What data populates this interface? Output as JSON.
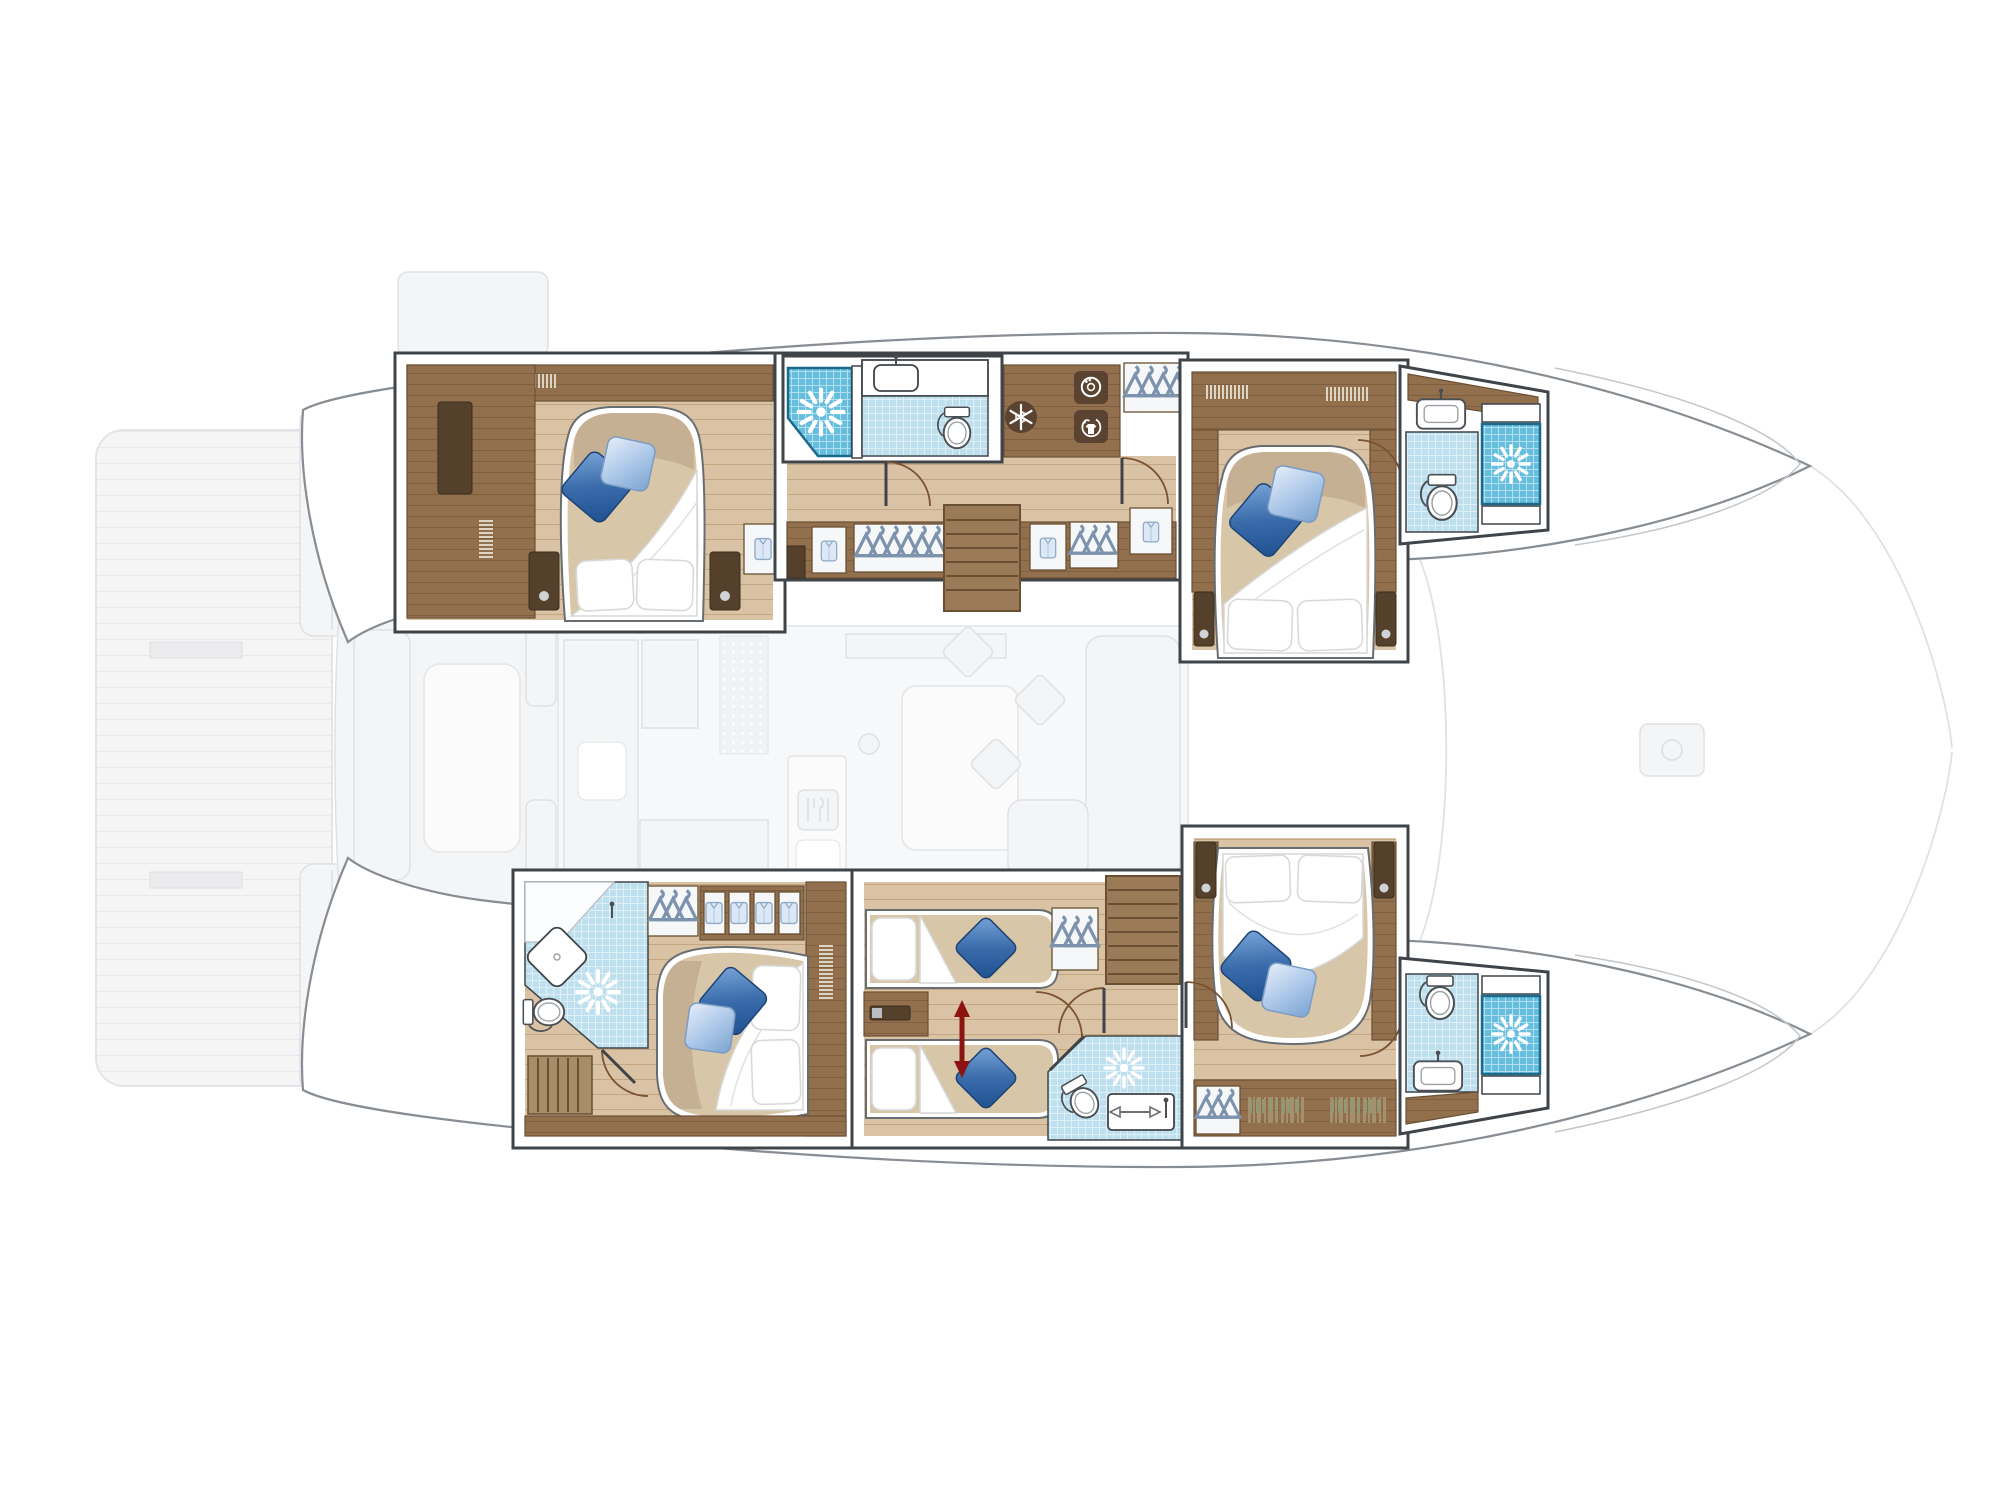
{
  "document": {
    "kind": "catamaran interior deck plan",
    "view": "top-down layout drawing, no text labels",
    "orientation": {
      "bow": "right",
      "stern": "left",
      "port_hull": "top",
      "starboard_hull": "bottom"
    }
  },
  "colors": {
    "wall_stroke": "#3f4449",
    "hull_stroke": "#878d92",
    "wood": "#92704e",
    "wood_dark": "#6a4f33",
    "wood_darker": "#55402b",
    "stair": "#9b7a57",
    "floor_base": "#d9c3a4",
    "plank_line": "#c2a781",
    "mattress": "#d8c6a9",
    "shower_tile": "#66bedf",
    "shower_edge": "#1b6a8c",
    "bath_tile": "#bedfed",
    "pillow_dark": "#2f5f9e",
    "pillow_light": "#a9c6e8",
    "door": "#7a5232",
    "convert_red": "#8c1310",
    "ghost_fill": "#f4f5f7",
    "ghost_stroke": "#dfe1e4"
  },
  "vessel": {
    "port_hull": {
      "cabins": [
        {
          "name": "aft double cabin",
          "bed": "island double, head aft",
          "pillows": [
            "white",
            "white",
            "dark blue",
            "light blue"
          ],
          "storage": [
            "full-height wardrobe",
            "shelves",
            "two bedside cabinets",
            "hanging locker"
          ]
        },
        {
          "name": "forward double cabin",
          "bed": "island double, head aft",
          "pillows": [
            "white",
            "white",
            "dark blue",
            "light blue"
          ],
          "storage": [
            "bedside cabinets",
            "shelf lockers"
          ]
        }
      ],
      "bathrooms": [
        {
          "name": "aft bathroom",
          "fixtures": [
            "shower with jets",
            "washbasin counter",
            "toilet"
          ]
        },
        {
          "name": "forward bathroom",
          "fixtures": [
            "washbasin",
            "toilet",
            "shower with jets"
          ]
        }
      ],
      "utilities": [
        "freezer (snowflake icon)",
        "washing machine (drum icon)",
        "tumble dryer (shirt icon)",
        "hanging wardrobes",
        "towel lockers"
      ],
      "stairs": "companionway down from saloon"
    },
    "starboard_hull": {
      "cabins": [
        {
          "name": "aft double cabin with ensuite",
          "bed": "island double, head forward",
          "pillows": [
            "white",
            "white",
            "dark blue",
            "light blue"
          ],
          "storage": [
            "shirt lockers",
            "hanging wardrobe",
            "slatted bench"
          ]
        },
        {
          "name": "midship twin cabin",
          "bed": "two single beds, convertible (red double arrow)",
          "pillows": [
            "white",
            "blue",
            "white",
            "blue"
          ],
          "storage": [
            "hanging wardrobe",
            "mid console"
          ]
        },
        {
          "name": "forward double cabin",
          "bed": "island double, head forward",
          "pillows": [
            "white",
            "white",
            "dark blue",
            "light blue"
          ],
          "storage": [
            "bookshelves",
            "hanging wardrobe"
          ]
        }
      ],
      "bathrooms": [
        {
          "name": "aft ensuite bathroom",
          "fixtures": [
            "corner shower with jets",
            "diamond washbasin",
            "toilet"
          ]
        },
        {
          "name": "midship shower room",
          "fixtures": [
            "shower with jets",
            "toilet",
            "washbasin"
          ]
        },
        {
          "name": "forward bathroom",
          "fixtures": [
            "toilet",
            "washbasin",
            "shower with jets"
          ]
        }
      ],
      "stairs": "companionway down from saloon"
    },
    "ghosted_main_deck": [
      "swim platform with teak planks",
      "transom steps both hulls",
      "aft cockpit bench and table",
      "saloon: galley counters, sink, fridge, dotted mat, cutlery locker, dining table, L-sofa with cushions",
      "foredeck hatches",
      "bowsprit rigging lines"
    ]
  },
  "icons": [
    {
      "name": "shower-jets-icon",
      "depicts": "white starburst water jets on blue tile",
      "count": 5
    },
    {
      "name": "snowflake-icon",
      "depicts": "freezer",
      "count": 1
    },
    {
      "name": "washing-machine-icon",
      "depicts": "washer drum",
      "count": 1
    },
    {
      "name": "dryer-shirt-icon",
      "depicts": "laundry shirt",
      "count": 1
    },
    {
      "name": "hanger-icon",
      "depicts": "clothes hangers in wardrobes"
    },
    {
      "name": "shirt-icon",
      "depicts": "folded garments in lockers"
    },
    {
      "name": "toilet-icon",
      "count": 5
    },
    {
      "name": "washbasin-icon",
      "count": 5
    },
    {
      "name": "convertible-beds-arrow",
      "depicts": "red double arrow between twin beds",
      "count": 1
    },
    {
      "name": "cutlery-icon",
      "depicts": "ghosted galley locker"
    }
  ],
  "counts": {
    "cabins": 5,
    "double_beds": 4,
    "single_beds": 2,
    "showers": 5,
    "toilets": 5,
    "washbasins": 5,
    "stairs": 2
  }
}
